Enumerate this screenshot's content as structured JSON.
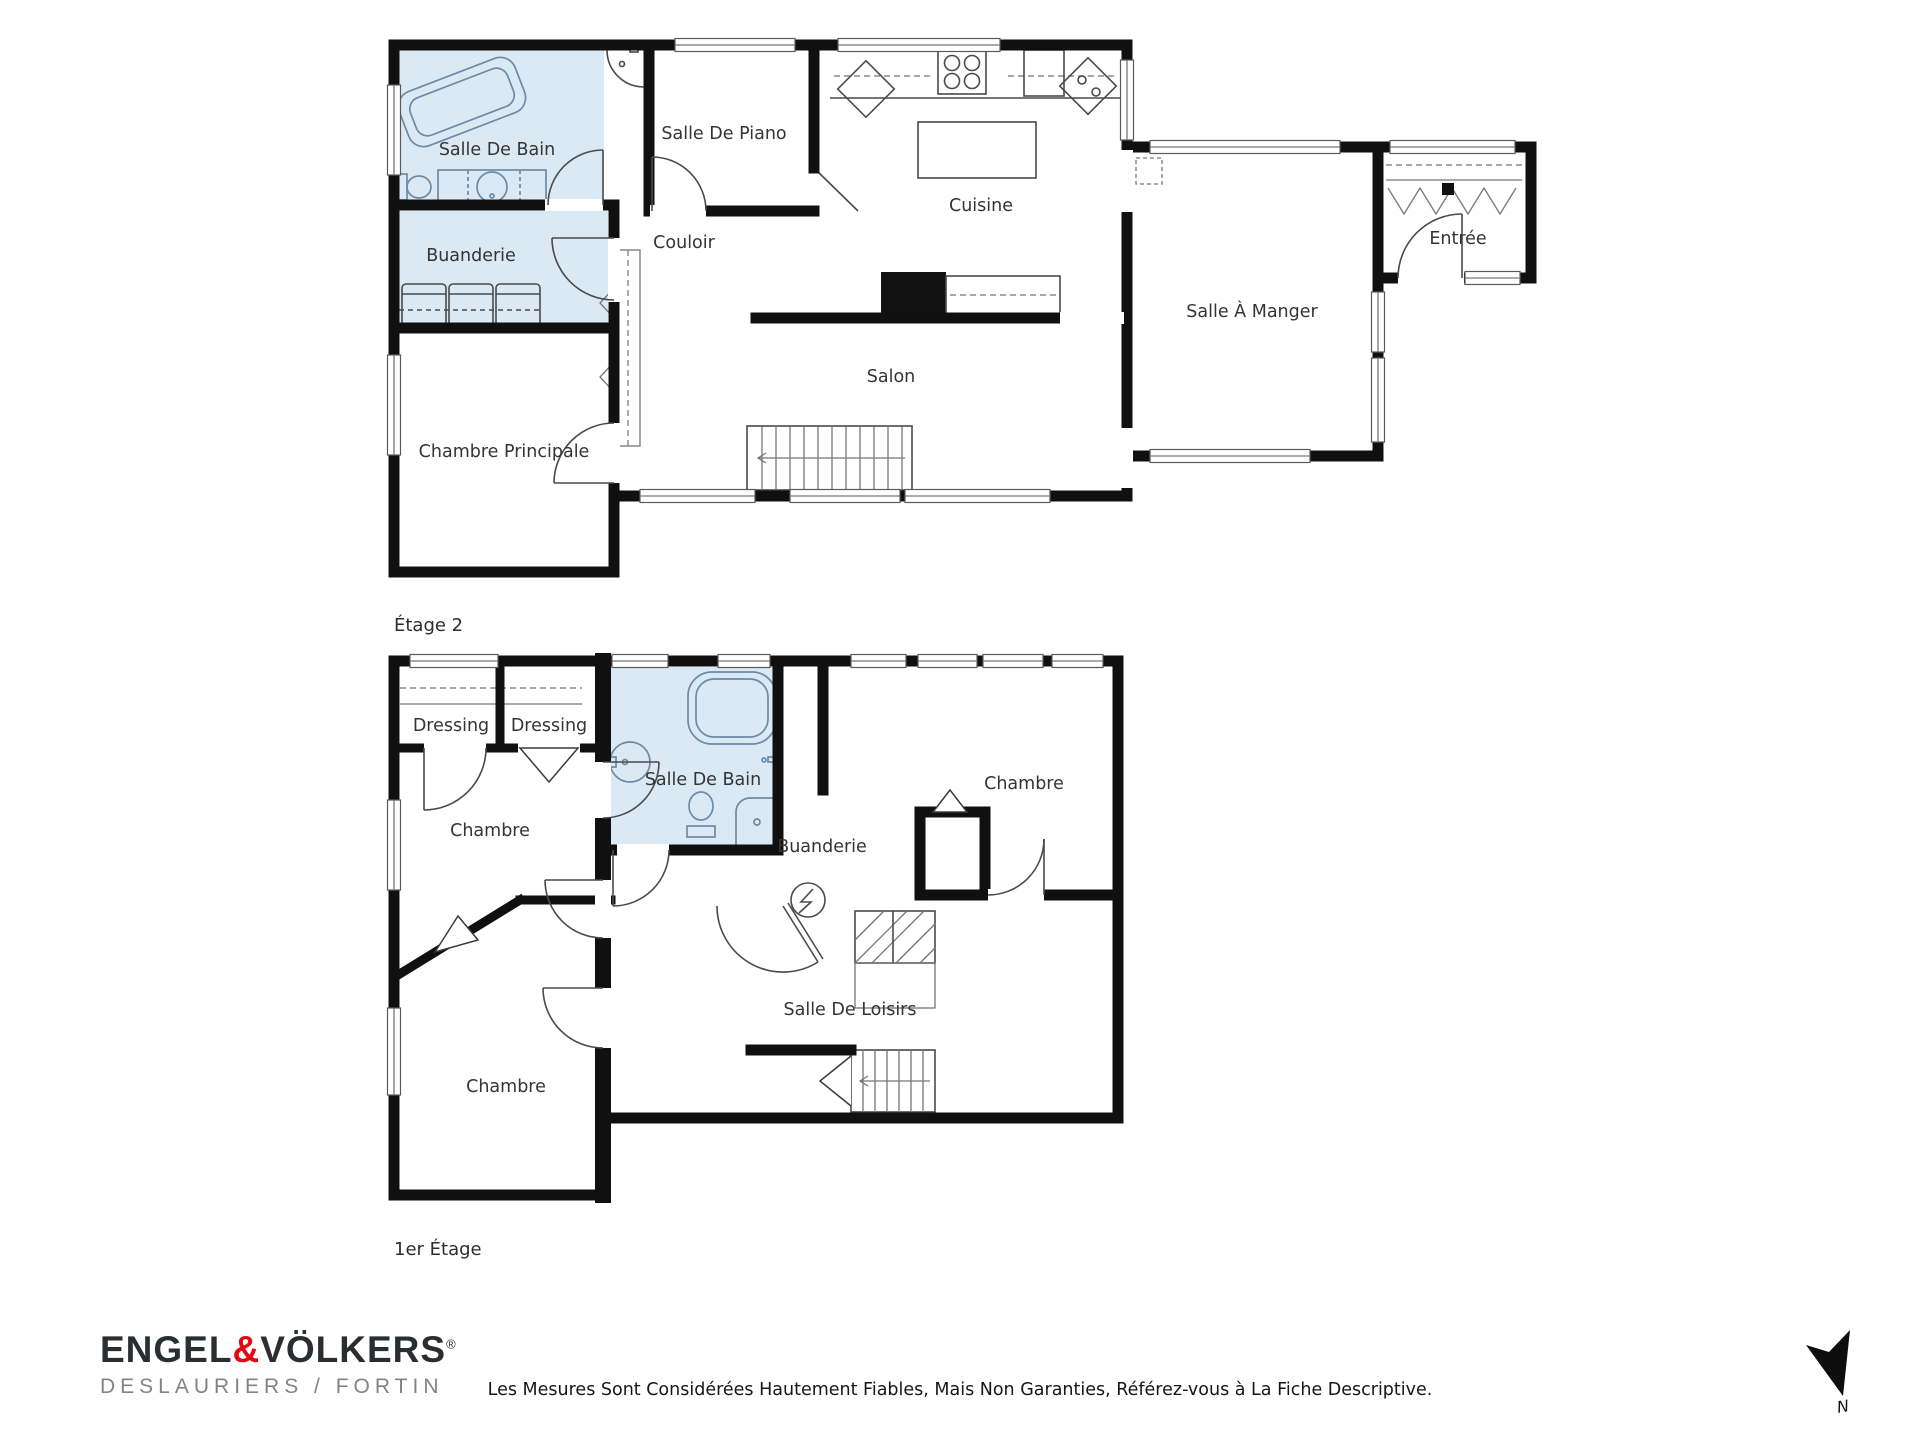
{
  "plans": {
    "etage2": {
      "caption": "Étage 2",
      "rooms": [
        {
          "id": "salle-de-bain",
          "label": "Salle De Bain"
        },
        {
          "id": "salle-de-piano",
          "label": "Salle De Piano"
        },
        {
          "id": "cuisine",
          "label": "Cuisine"
        },
        {
          "id": "couloir",
          "label": "Couloir"
        },
        {
          "id": "buanderie",
          "label": "Buanderie"
        },
        {
          "id": "salon",
          "label": "Salon"
        },
        {
          "id": "chambre-principale",
          "label": "Chambre Principale"
        },
        {
          "id": "salle-a-manger",
          "label": "Salle À Manger"
        },
        {
          "id": "entree",
          "label": "Entrée"
        }
      ]
    },
    "etage1": {
      "caption": "1er Étage",
      "rooms": [
        {
          "id": "dressing-1",
          "label": "Dressing"
        },
        {
          "id": "dressing-2",
          "label": "Dressing"
        },
        {
          "id": "salle-de-bain",
          "label": "Salle De Bain"
        },
        {
          "id": "chambre-droite",
          "label": "Chambre"
        },
        {
          "id": "buanderie",
          "label": "Buanderie"
        },
        {
          "id": "chambre-milieu",
          "label": "Chambre"
        },
        {
          "id": "chambre-bas",
          "label": "Chambre"
        },
        {
          "id": "salle-de-loisirs",
          "label": "Salle De Loisirs"
        }
      ]
    }
  },
  "footer": {
    "brand": {
      "part1": "ENGEL",
      "amp": "&",
      "part2": "VÖLKERS",
      "registered": "®",
      "subtitle": "DESLAURIERS / FORTIN"
    },
    "disclaimer": "Les Mesures Sont Considérées Hautement Fiables, Mais Non Garanties, Référez-vous à La Fiche Descriptive.",
    "compass_label": "N"
  },
  "colors": {
    "wall": "#101010",
    "wet_room_fill": "#dbe9f5",
    "brand_red": "#e30613",
    "brand_dark": "#2b2e31",
    "brand_gray": "#808487",
    "detail_line": "#4a4a4a",
    "label_text": "#343434"
  }
}
